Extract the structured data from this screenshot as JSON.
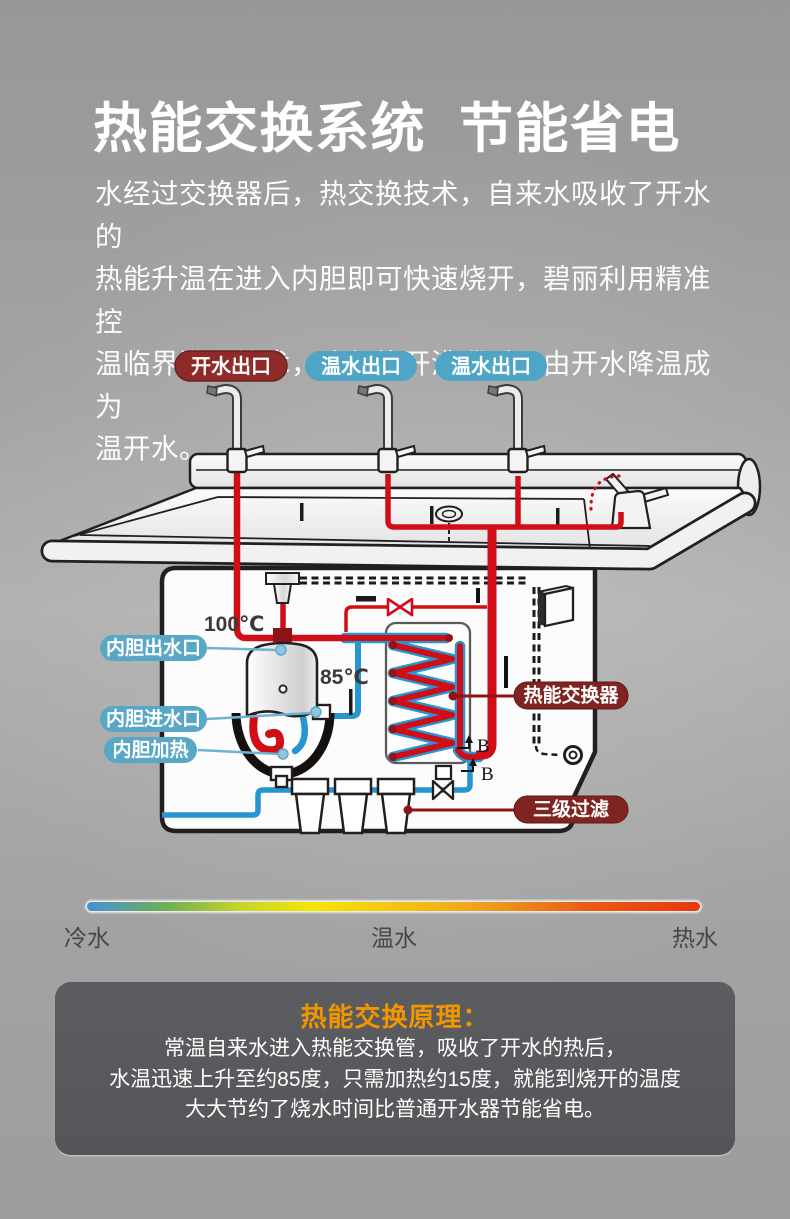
{
  "header": {
    "title": "热能交换系统  节能省电",
    "paragraph_lines": [
      "水经过交换器后，热交换技术，自来水吸收了开水的",
      "热能升温在进入内胆即可快速烧开，碧丽利用精准控",
      "温临界沸腾技术，确保烧开沸腾后，由开水降温成为",
      "温开水。"
    ]
  },
  "diagram": {
    "outlets": [
      {
        "text": "开水出口",
        "color": "#8e2b28"
      },
      {
        "text": "温水出口",
        "color": "#4fa5c6"
      },
      {
        "text": "温水出口",
        "color": "#4fa5c6"
      }
    ],
    "temps": {
      "boiling": "100℃",
      "warm": "85℃"
    },
    "tank_labels": [
      {
        "text": "内胆出水口"
      },
      {
        "text": "内胆进水口"
      },
      {
        "text": "内胆加热"
      }
    ],
    "side_labels": [
      {
        "text": "热能交换器"
      },
      {
        "text": "三级过滤"
      }
    ],
    "b_marks": [
      {
        "text": "B"
      },
      {
        "text": "B"
      }
    ],
    "colors": {
      "hot_pipe": "#cf0e18",
      "cold_pipe": "#2596cf",
      "label_blue": "#58a7c7",
      "label_dark_red": "#7f2420",
      "outlet_dark_red": "#8e2b28",
      "outlet_blue": "#4fa5c6",
      "outline": "#231f20"
    }
  },
  "temperature_scale": {
    "labels": [
      {
        "text": "冷水"
      },
      {
        "text": "温水"
      },
      {
        "text": "热水"
      }
    ]
  },
  "principle_box": {
    "title": "热能交换原理：",
    "title_color": "#f29600",
    "lines": [
      "常温自来水进入热能交换管，吸收了开水的热后，",
      "水温迅速上升至约85度，只需加热约15度，就能到烧开的温度",
      "大大节约了烧水时间比普通开水器节能省电。"
    ]
  }
}
